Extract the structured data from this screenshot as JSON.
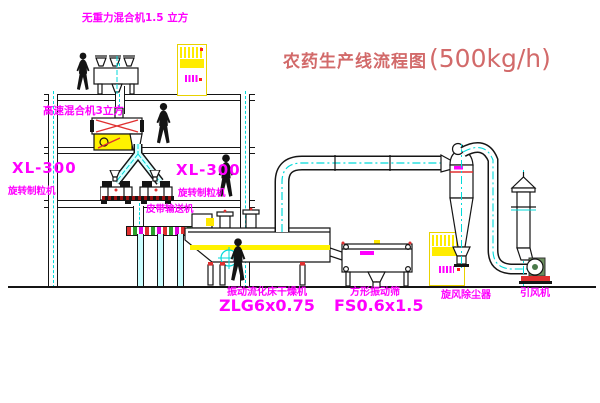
{
  "title": {
    "cn": "农药生产线流程图",
    "capacity": "(500kg/h)"
  },
  "labels": {
    "mixer_top": "无重力混合机1.5 立方",
    "mixer_mid": "高速混合机3立方",
    "granulator_left_model": "XL-300",
    "granulator_left_name": "旋转制粒机",
    "granulator_right_model": "XL-300",
    "granulator_right_name": "旋转制粒机",
    "belt_conveyor": "皮带输送机",
    "dryer_name": "振动流化床干燥机",
    "dryer_model": "ZLG6x0.75",
    "screen_name": "方形振动筛",
    "screen_model": "FS0.6x1.5",
    "cyclone": "旋风除尘器",
    "fan": "引风机"
  },
  "colors": {
    "label_magenta": "#ff00ff",
    "title_red": "#d26a6a",
    "centerline_cyan": "#00dada",
    "highlight_yellow": "#fff200",
    "accent_red": "#e03030",
    "line_black": "#151515",
    "belt_green": "#2aa02a"
  }
}
